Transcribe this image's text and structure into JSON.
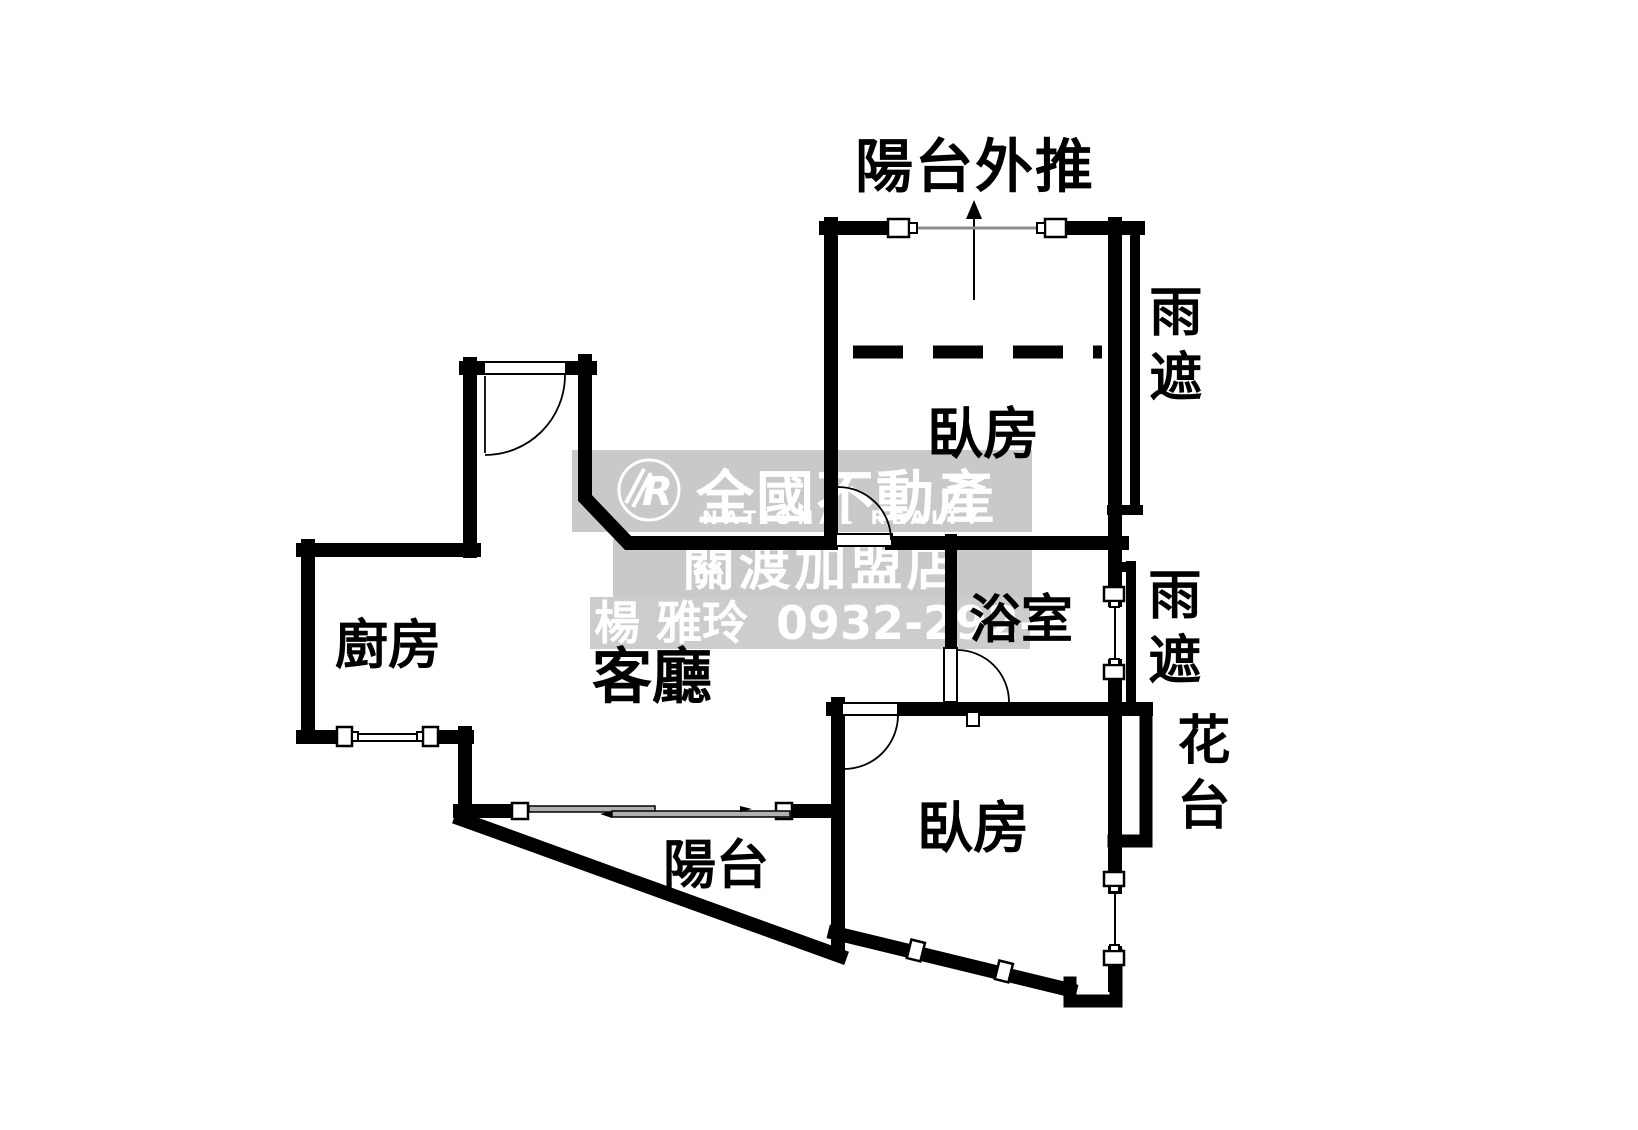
{
  "plan_title": "陽台外推",
  "rooms": {
    "bedroom_upper": "臥房",
    "bedroom_lower": "臥房",
    "bathroom": "浴室",
    "kitchen": "廚房",
    "living_room": "客廳",
    "balcony": "陽台"
  },
  "annotations": {
    "rain_shelter_upper": "雨遮",
    "rain_shelter_lower": "雨遮",
    "flower_stand": "花台"
  },
  "watermark": {
    "logo_letter": "R",
    "company": "全國不動產",
    "company_en": "NATIONAL REALTY",
    "branch": "關渡加盟店",
    "agent": "楊 雅玲",
    "phone": "0932-292-690",
    "band_color": "#c9c9c9",
    "text_color": "#ffffff"
  },
  "colors": {
    "wall": "#000000",
    "background": "#ffffff",
    "window_line": "#8c8c8c",
    "sliding_panel": "#b0b0b0"
  }
}
